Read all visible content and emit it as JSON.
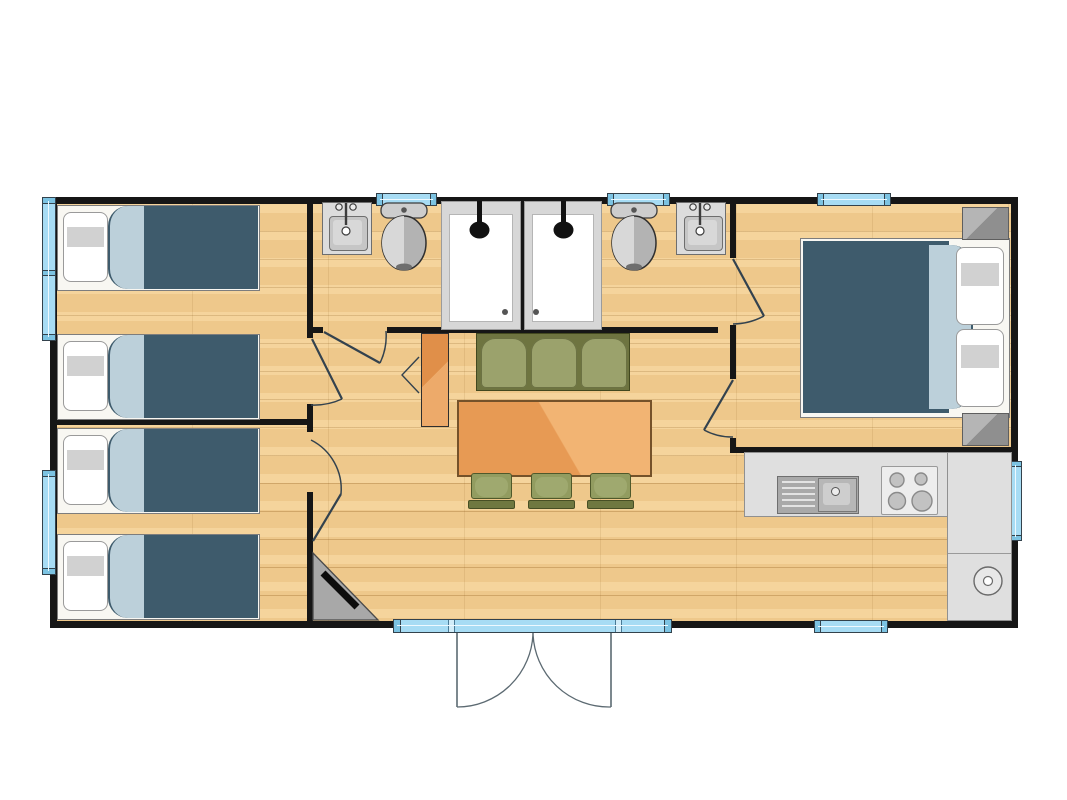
{
  "document": {
    "type": "floor-plan",
    "description": "Top-down architectural floor plan of a rectangular mobile home: two twin bedrooms on the left, central double bathroom block (two showers, two toilets, two washbasins), open living-dining area with sofa, table and chairs, kitchen corner at bottom right and a master bedroom with double bed at top right. No text labels are rendered.",
    "background": "#ffffff"
  },
  "colors": {
    "wall": "#161616",
    "floor": "#f3cd90",
    "window": "#a7dcf4",
    "windowCap": "#7cc3e2",
    "bedFrame": "#f8f7f2",
    "bedCover": "#3e5b6c",
    "bedSheet": "#bcd0da",
    "pillow": "#ffffff",
    "pillowShade": "#c9c9c9",
    "sofaFrame": "#6e7440",
    "sofaCushion": "#9ba26c",
    "table": "#e79a54",
    "tableHighlight": "#f2b473",
    "chairSeat": "#929c60",
    "sideboard": "#e08f49",
    "sideboardHighlight": "#edaa6a",
    "counter": "#dfdfdf",
    "doorArc": "#33424e",
    "entranceArc": "#5c6a72",
    "tvUnit": "#a8a8a8",
    "fixtureBlack": "#111111"
  },
  "inventory": {
    "single_beds": 4,
    "double_beds": 1,
    "pillows": 6,
    "nightstands": 2,
    "shower_cabins": 2,
    "toilets": 2,
    "washbasins": 2,
    "kitchen_sink_with_drainboard": 1,
    "hob_burners": 4,
    "round_kitchen_fixture": 1,
    "sofa_seats": 3,
    "dining_table": 1,
    "dining_chairs": 3,
    "sideboard": 1,
    "corner_tv_unit": 1,
    "interior_doors": 5,
    "entrance_double_door_leaves": 2,
    "windows": 8
  }
}
